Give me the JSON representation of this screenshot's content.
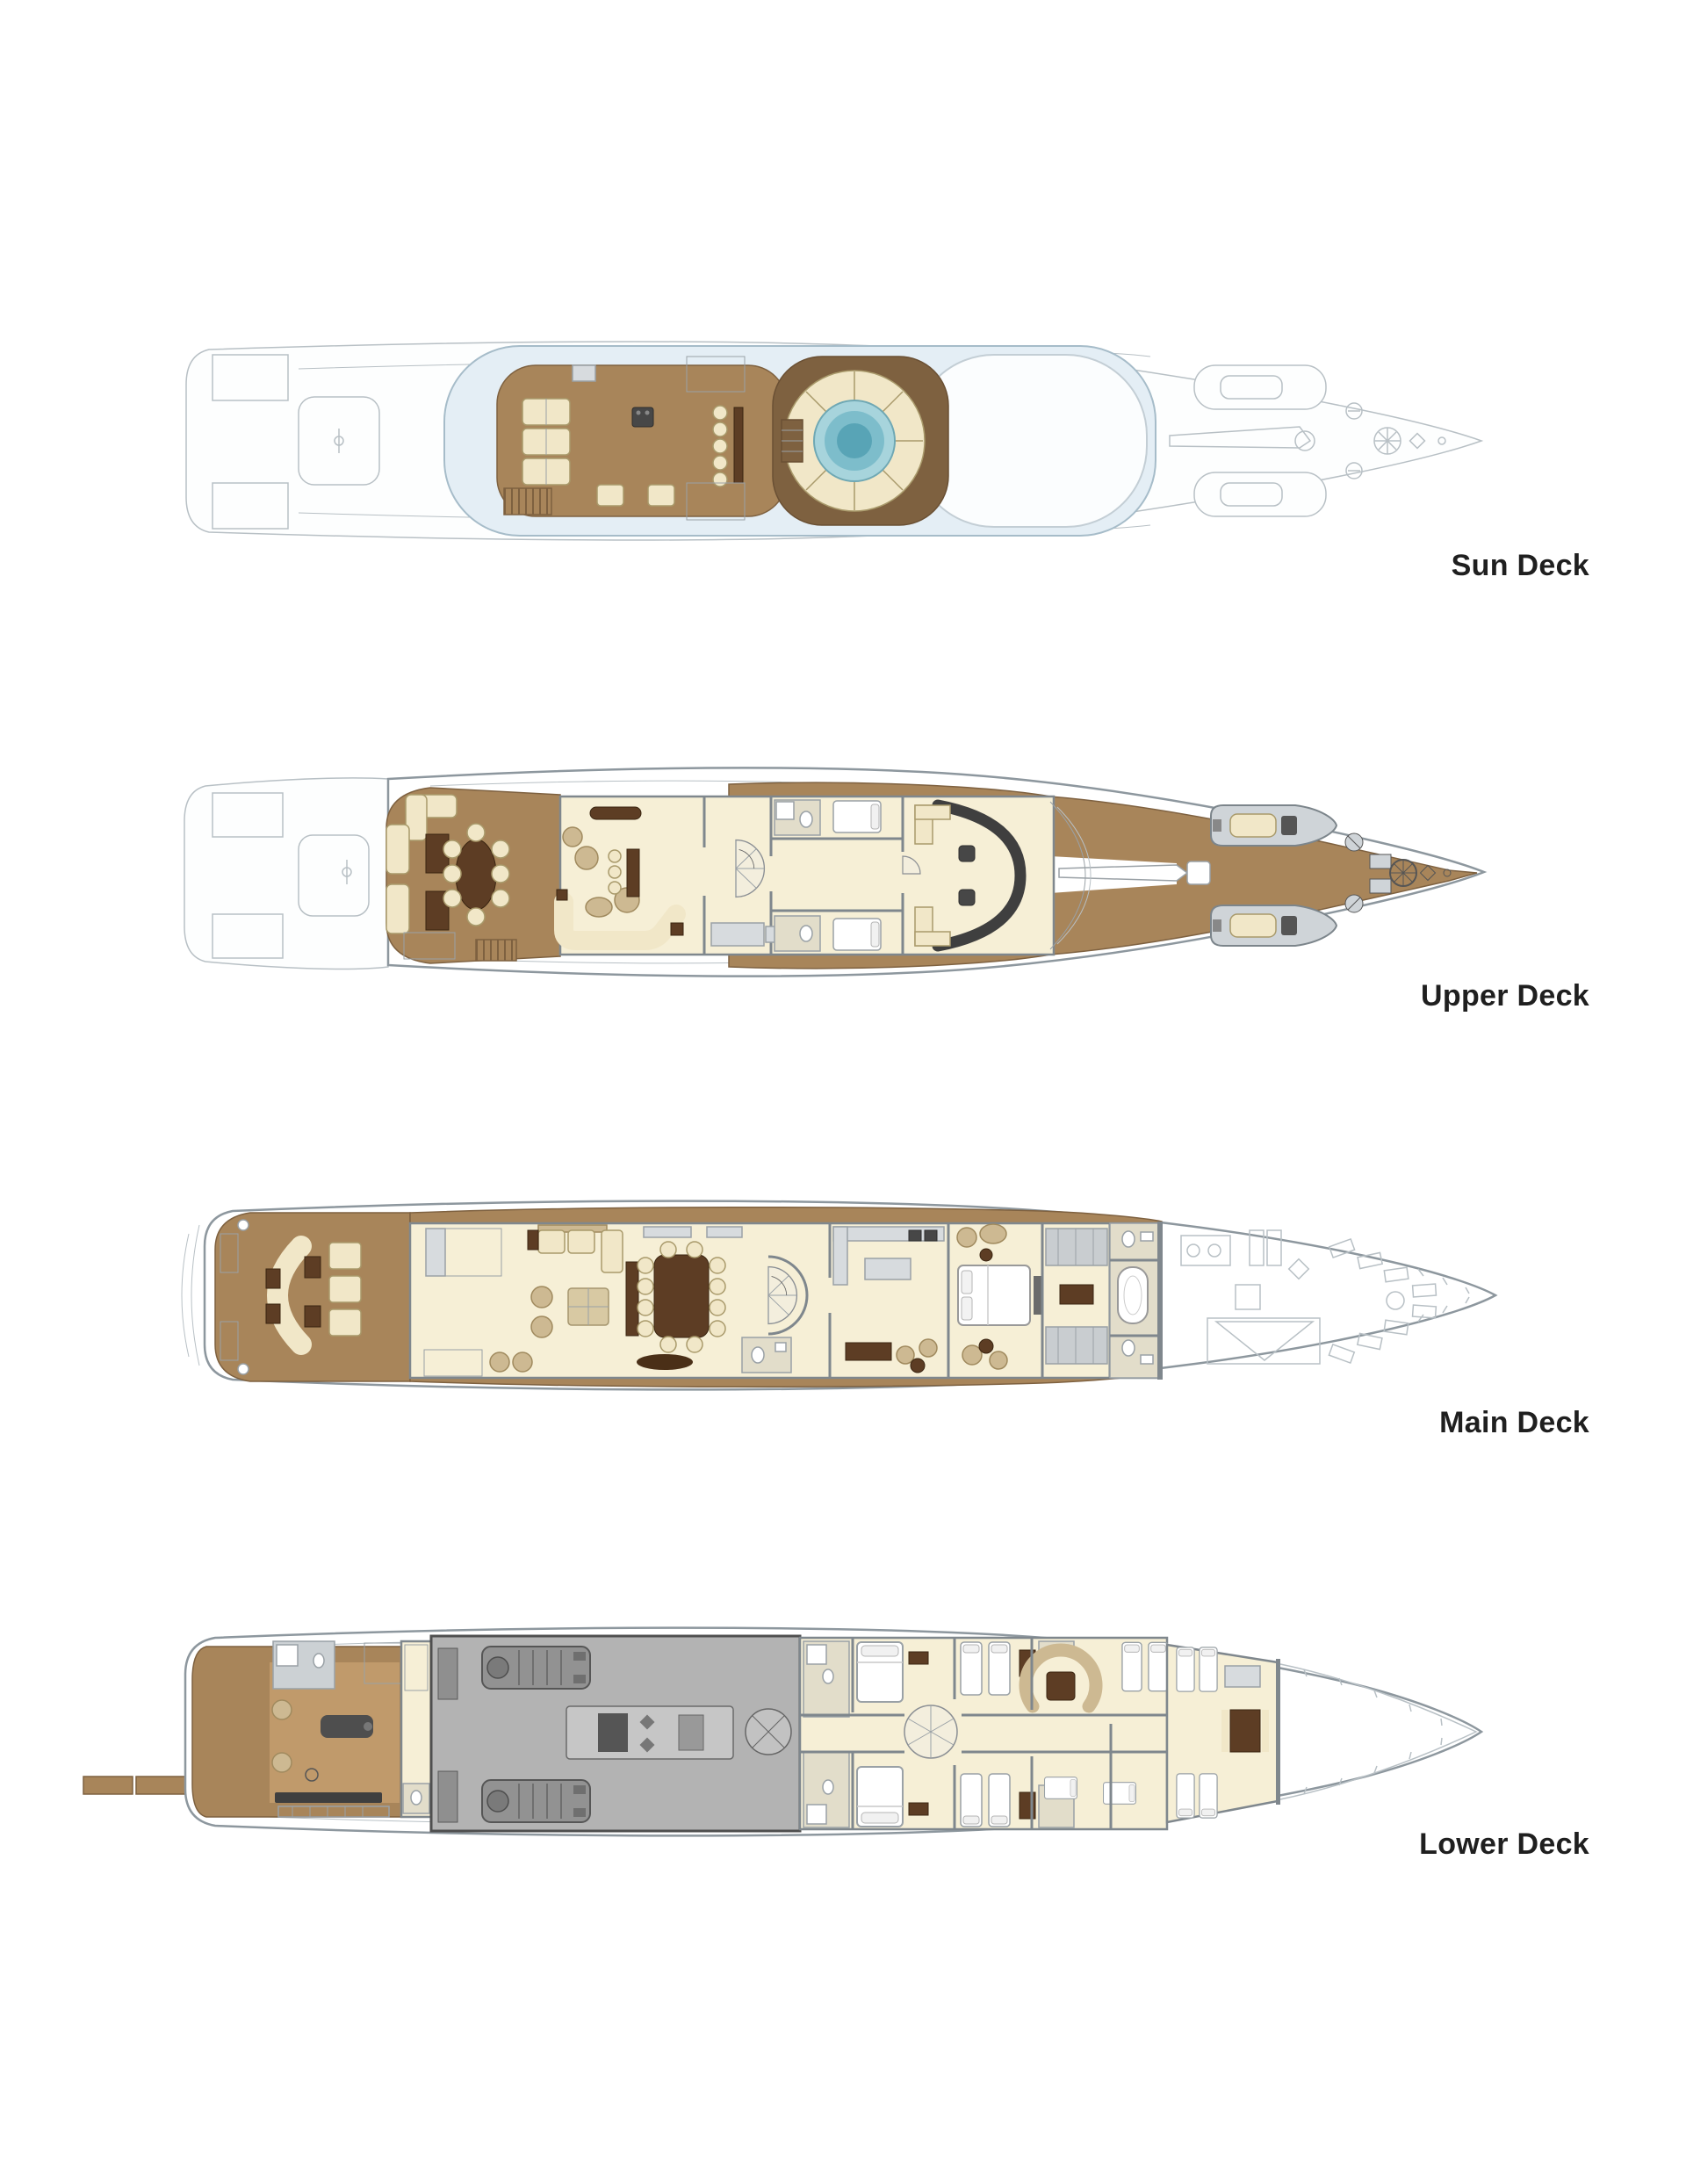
{
  "decks": [
    {
      "id": "sun-deck",
      "label": "Sun Deck"
    },
    {
      "id": "upper-deck",
      "label": "Upper Deck"
    },
    {
      "id": "main-deck",
      "label": "Main Deck"
    },
    {
      "id": "lower-deck",
      "label": "Lower Deck"
    }
  ],
  "colors": {
    "background": "#ffffff",
    "label": "#1f1f1f",
    "teak": "#a8855a",
    "teak-light": "#c09a6b",
    "teak-dark": "#7e6140",
    "walnut": "#5d3d24",
    "cream": "#f6efd6",
    "pad": "#f1e7c8",
    "pad-edge": "#a99a6b",
    "beige": "#cdb992",
    "glass": "#e4eef5",
    "glass-edge": "#a6bcc9",
    "pool": "#a7d4dc",
    "pool-mid": "#7dbdcb",
    "pool-deep": "#58a4b6",
    "ghost": "#b8c0c5",
    "hull": "#8d979e",
    "wall": "#7f878d",
    "steel": "#d7dbde",
    "steel-dark": "#9aa1a6",
    "engine-floor": "#b3b3b3",
    "engine": "#929292",
    "engine-edge": "#565656",
    "tile": "#e2ddca"
  }
}
